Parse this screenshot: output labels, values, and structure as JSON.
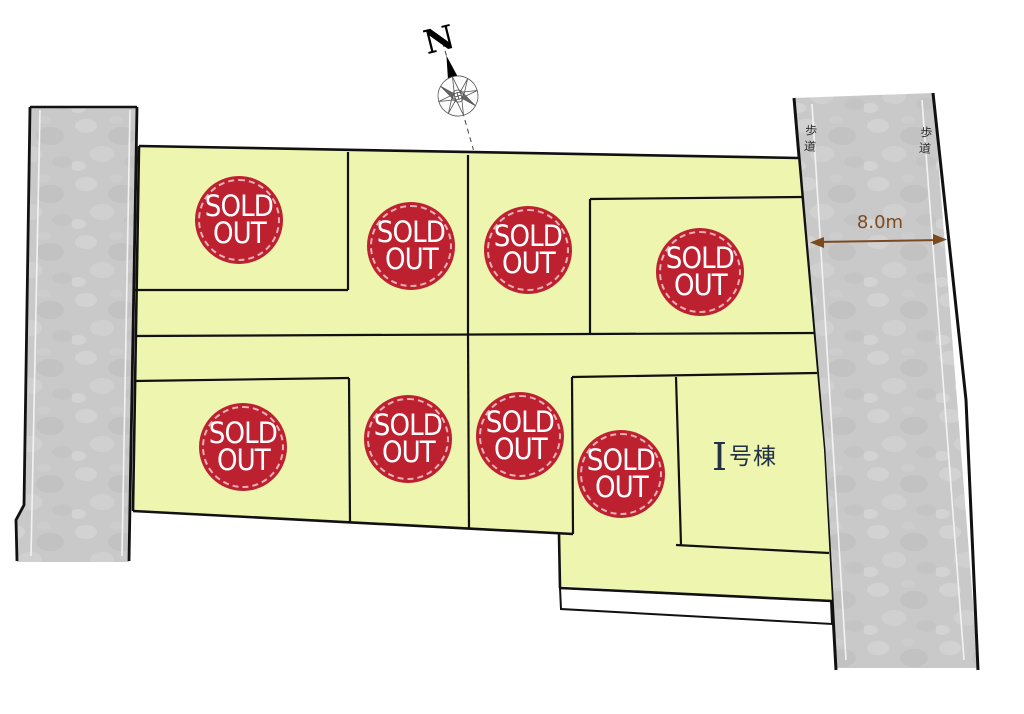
{
  "title": "分譲地区画図 (subdivision lot map)",
  "compass": {
    "north_label": "N"
  },
  "roads": {
    "left": {
      "surface": "concrete",
      "fill_color": "#c9c9c9"
    },
    "right": {
      "surface": "concrete",
      "fill_color": "#c9c9c9",
      "sidewalk_label_left": "歩道",
      "sidewalk_label_right": "歩道",
      "width_dimension": "8.0m",
      "dimension_color": "#7c4a21"
    }
  },
  "site": {
    "lot_fill_color": "#eef5ae",
    "outline_color": "#111111",
    "sold_lot_count": 8,
    "available_unit_count": 1
  },
  "badges": [
    {
      "line1": "SOLD",
      "line2": "OUT"
    },
    {
      "line1": "SOLD",
      "line2": "OUT"
    },
    {
      "line1": "SOLD",
      "line2": "OUT"
    },
    {
      "line1": "SOLD",
      "line2": "OUT"
    },
    {
      "line1": "SOLD",
      "line2": "OUT"
    },
    {
      "line1": "SOLD",
      "line2": "OUT"
    },
    {
      "line1": "SOLD",
      "line2": "OUT"
    },
    {
      "line1": "SOLD",
      "line2": "OUT"
    }
  ],
  "badge_style": {
    "background_color": "#bd2130",
    "text_color": "#ffffff"
  },
  "building_lot": {
    "label_prefix": "I",
    "label_suffix": "号棟",
    "full_label": "I号棟"
  }
}
